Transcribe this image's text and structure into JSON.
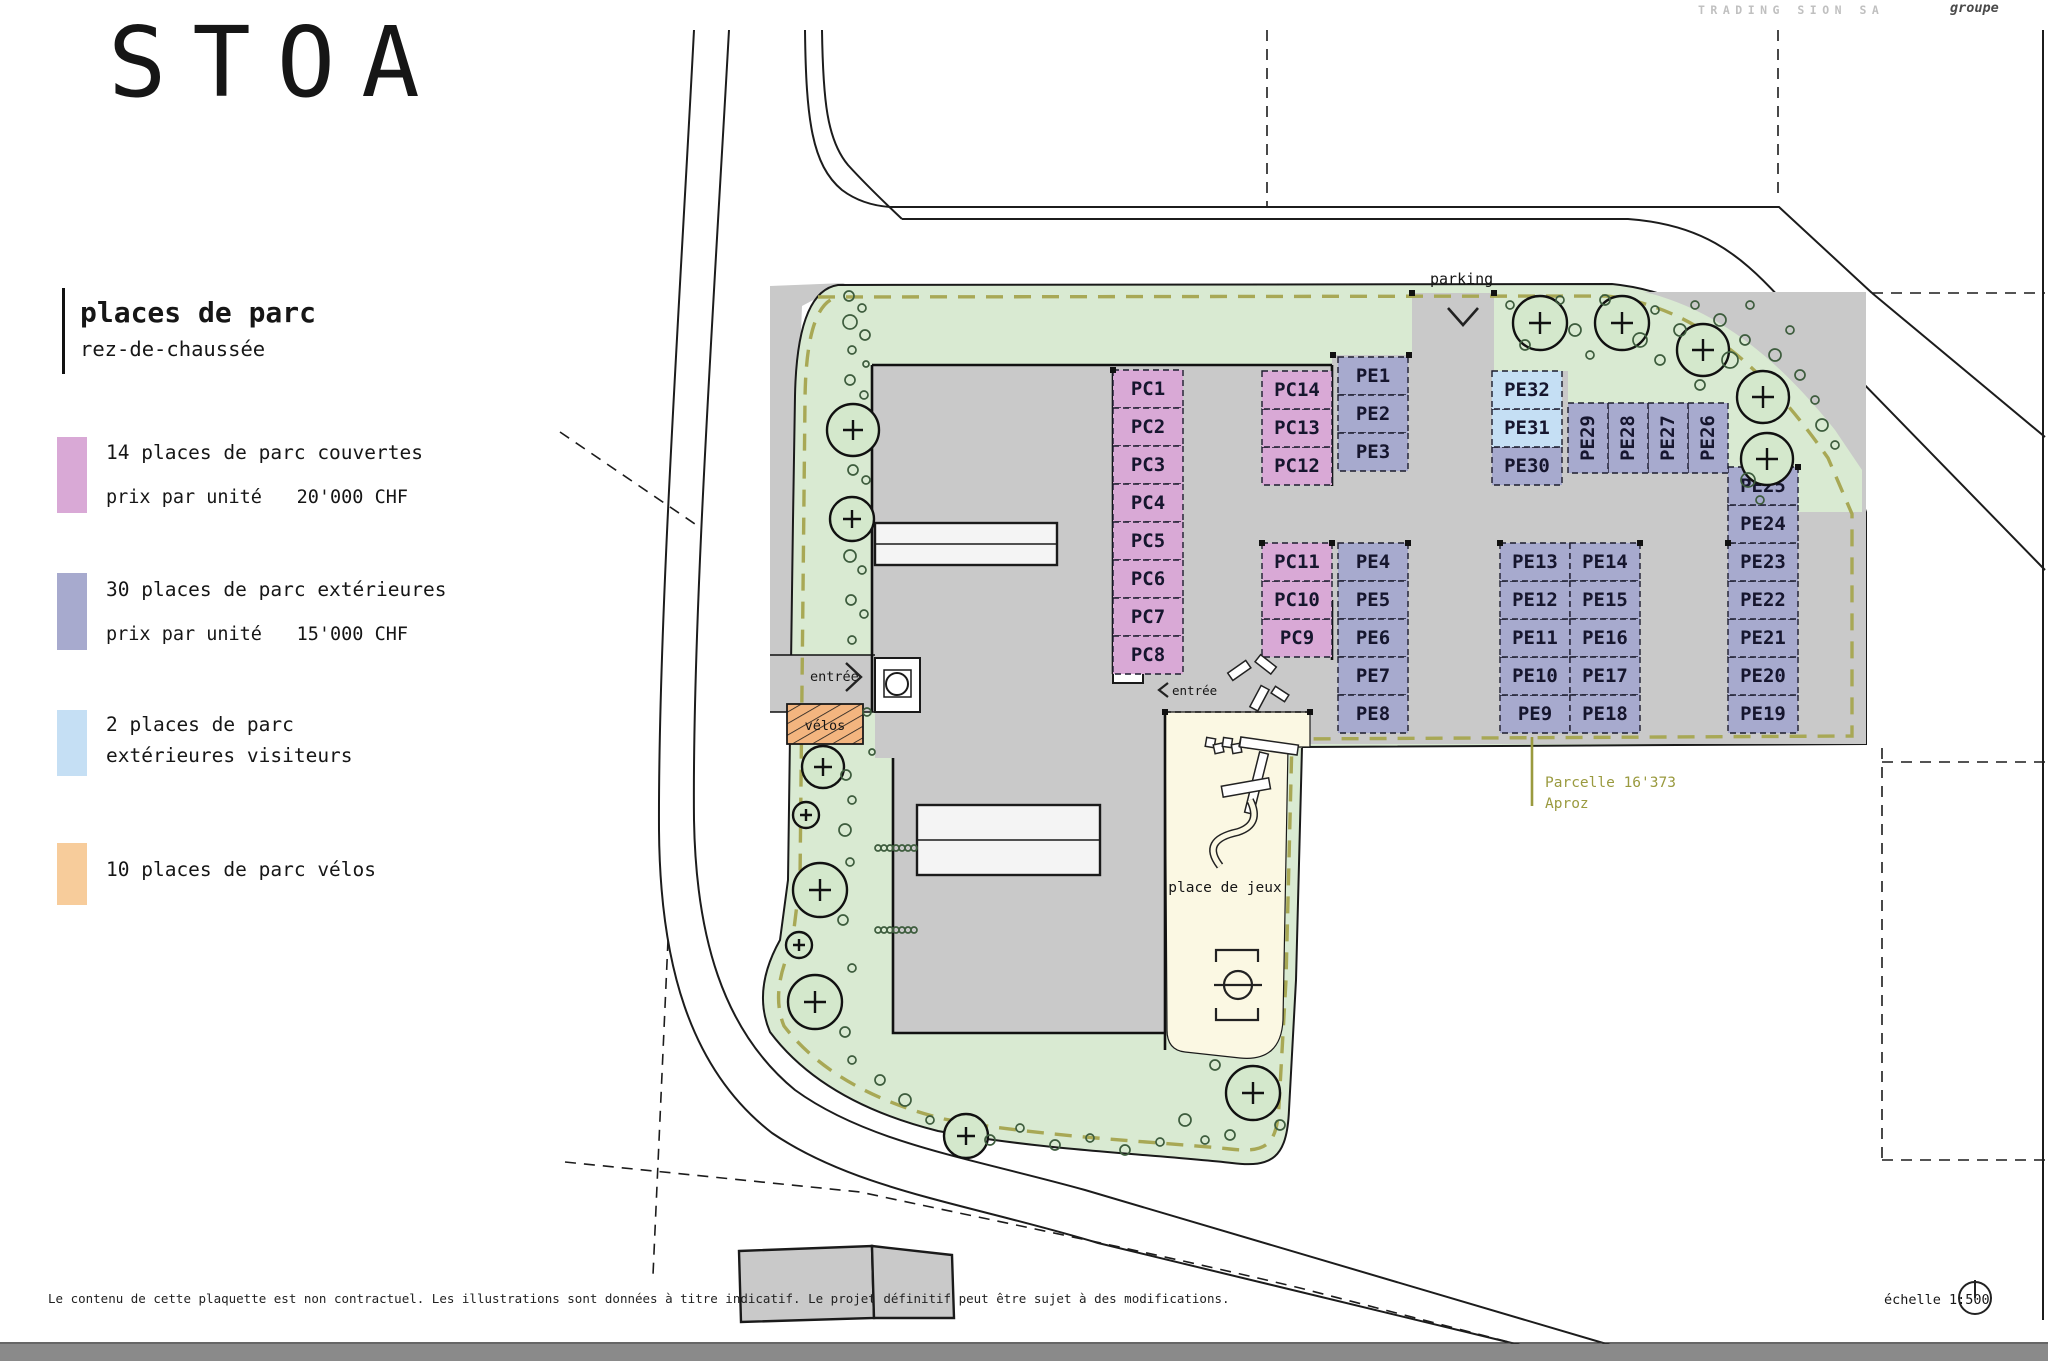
{
  "header": {
    "logo": "STOA",
    "company": "TRADING SION SA",
    "brand": "groupe"
  },
  "legend": {
    "title": "places de parc",
    "subtitle": "rez-de-chaussée",
    "items": [
      {
        "label": "14 places de parc couvertes",
        "price_label": "prix par unité",
        "price": "20'000 CHF",
        "color": "#d9a9d6"
      },
      {
        "label": "30 places de parc extérieures",
        "price_label": "prix par unité",
        "price": "15'000 CHF",
        "color": "#a7aace"
      },
      {
        "label": "2 places de parc",
        "label2": "extérieures visiteurs",
        "color": "#c5dff4"
      },
      {
        "label": "10 places de parc vélos",
        "color": "#f3b57f"
      }
    ]
  },
  "plan": {
    "labels": {
      "parking": "parking",
      "entree_west": "entrée",
      "entree_east": "entrée",
      "velos": "vélos",
      "playground": "place de jeux",
      "parcel_line1": "Parcelle 16'373",
      "parcel_line2": "Aproz"
    },
    "stalls": {
      "pc": [
        "PC1",
        "PC2",
        "PC3",
        "PC4",
        "PC5",
        "PC6",
        "PC7",
        "PC8",
        "PC9",
        "PC10",
        "PC11",
        "PC12",
        "PC13",
        "PC14"
      ],
      "pe": [
        "PE1",
        "PE2",
        "PE3",
        "PE4",
        "PE5",
        "PE6",
        "PE7",
        "PE8",
        "PE9",
        "PE10",
        "PE11",
        "PE12",
        "PE13",
        "PE14",
        "PE15",
        "PE16",
        "PE17",
        "PE18",
        "PE19",
        "PE20",
        "PE21",
        "PE22",
        "PE23",
        "PE24",
        "PE25",
        "PE26",
        "PE27",
        "PE28",
        "PE29",
        "PE30",
        "PE31",
        "PE32"
      ]
    },
    "colors": {
      "covered": "#d9a9d6",
      "exterior": "#a7aace",
      "visitor": "#c5dff4",
      "bikes": "#f3b57f",
      "landscape": "#d9ead2",
      "paving": "#c9c9c9",
      "playground": "#fbf8e3",
      "parcel_dash": "#a8a855"
    }
  },
  "footer": {
    "disclaimer": "Le contenu de cette plaquette est non contractuel. Les illustrations sont données à titre indicatif. Le projet définitif peut être sujet à des modifications.",
    "scale": "échelle 1:500"
  }
}
